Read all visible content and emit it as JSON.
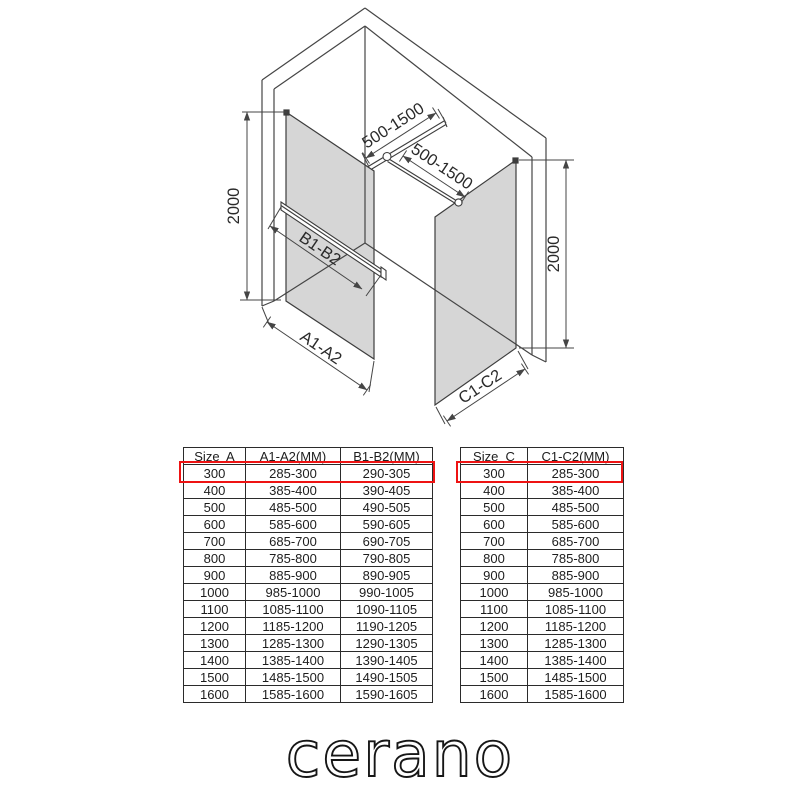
{
  "drawing": {
    "labels": {
      "height_left": "2000",
      "height_right": "2000",
      "bar_top": "500-1500",
      "bar_right": "500-1500",
      "width_a": "A1-A2",
      "width_b": "B1-B2",
      "width_c": "C1-C2"
    },
    "colors": {
      "line": "#454545",
      "glass": "#d6d6d6"
    }
  },
  "tables": {
    "highlight_color": "#ee1313",
    "left": {
      "headers": [
        "Size  A",
        "A1-A2(MM)",
        "B1-B2(MM)"
      ],
      "rows": [
        [
          "300",
          "285-300",
          "290-305"
        ],
        [
          "400",
          "385-400",
          "390-405"
        ],
        [
          "500",
          "485-500",
          "490-505"
        ],
        [
          "600",
          "585-600",
          "590-605"
        ],
        [
          "700",
          "685-700",
          "690-705"
        ],
        [
          "800",
          "785-800",
          "790-805"
        ],
        [
          "900",
          "885-900",
          "890-905"
        ],
        [
          "1000",
          "985-1000",
          "990-1005"
        ],
        [
          "1100",
          "1085-1100",
          "1090-1105"
        ],
        [
          "1200",
          "1185-1200",
          "1190-1205"
        ],
        [
          "1300",
          "1285-1300",
          "1290-1305"
        ],
        [
          "1400",
          "1385-1400",
          "1390-1405"
        ],
        [
          "1500",
          "1485-1500",
          "1490-1505"
        ],
        [
          "1600",
          "1585-1600",
          "1590-1605"
        ]
      ],
      "highlighted_row": 0
    },
    "right": {
      "headers": [
        "Size  C",
        "C1-C2(MM)"
      ],
      "rows": [
        [
          "300",
          "285-300"
        ],
        [
          "400",
          "385-400"
        ],
        [
          "500",
          "485-500"
        ],
        [
          "600",
          "585-600"
        ],
        [
          "700",
          "685-700"
        ],
        [
          "800",
          "785-800"
        ],
        [
          "900",
          "885-900"
        ],
        [
          "1000",
          "985-1000"
        ],
        [
          "1100",
          "1085-1100"
        ],
        [
          "1200",
          "1185-1200"
        ],
        [
          "1300",
          "1285-1300"
        ],
        [
          "1400",
          "1385-1400"
        ],
        [
          "1500",
          "1485-1500"
        ],
        [
          "1600",
          "1585-1600"
        ]
      ],
      "highlighted_row": 0
    }
  },
  "brand": {
    "logo": "cerano"
  }
}
